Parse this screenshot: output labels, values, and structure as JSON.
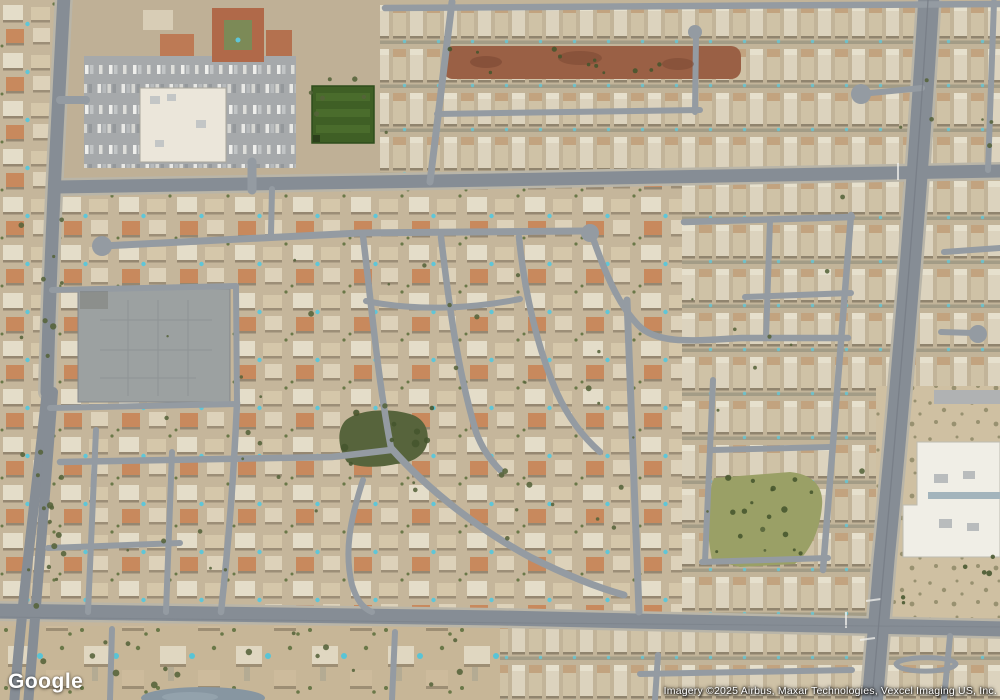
{
  "page": {
    "width": 1000,
    "height": 700,
    "view": "satellite"
  },
  "branding": {
    "logo_text": "Google"
  },
  "attribution": {
    "text": "Imagery ©2025 Airbus, Maxar Technologies, Vexcel Imaging US, Inc."
  },
  "palette": {
    "base": "#c6b69b",
    "street": "#949ba2",
    "arterial": "#868d95",
    "casing": "#b9b5a8",
    "dirt": "#9a6045",
    "field": "#3f5f25",
    "fieldStripe": "#4a6c2c",
    "park": "#57643c",
    "brush": "#9aa066",
    "pad": "#9ca1a1",
    "lot": "#a6a9ab",
    "store": "#ebe6da",
    "red": "#b06949",
    "redwing": "#b4714f",
    "white": "#f0eee6",
    "pond": "#8796a1",
    "pool": "#5ec6d8",
    "sand": "#cfc0a2",
    "tree": "#55633a",
    "treeDark": "#46552e",
    "unit": "#c3c6c6"
  },
  "map": {
    "regions": [
      {
        "name": "base-desert",
        "kind": "rect",
        "geom": [
          0,
          0,
          1000,
          700
        ],
        "fill": "$base"
      },
      {
        "name": "residential-bottom-left",
        "kind": "rect",
        "geom": [
          0,
          626,
          505,
          74
        ],
        "fill": "pat:lots"
      },
      {
        "name": "residential-bottom-right",
        "kind": "rect",
        "geom": [
          500,
          626,
          500,
          74
        ],
        "fill": "pat:rows"
      },
      {
        "name": "residential-top-right",
        "kind": "rect",
        "geom": [
          378,
          0,
          622,
          184
        ],
        "fill": "pat:rows"
      },
      {
        "name": "residential-top-left-corner",
        "kind": "rect",
        "geom": [
          0,
          0,
          60,
          188
        ],
        "fill": "pat:sub"
      },
      {
        "name": "commercial-apron",
        "kind": "rect",
        "geom": [
          58,
          0,
          322,
          188
        ],
        "fill": "#bfb096"
      },
      {
        "name": "residential-left-mid",
        "kind": "rect",
        "geom": [
          0,
          186,
          332,
          430
        ],
        "fill": "pat:sub"
      },
      {
        "name": "residential-center-fan",
        "kind": "rect",
        "geom": [
          332,
          186,
          352,
          430
        ],
        "fill": "pat:sub"
      },
      {
        "name": "residential-right-grid",
        "kind": "rect",
        "geom": [
          682,
          178,
          198,
          440
        ],
        "fill": "pat:rows"
      },
      {
        "name": "residential-east-top",
        "kind": "rect",
        "geom": [
          878,
          0,
          122,
          390
        ],
        "fill": "pat:rows"
      },
      {
        "name": "desert-east",
        "kind": "rect",
        "geom": [
          876,
          386,
          124,
          232
        ],
        "fill": "pat:shrub"
      },
      {
        "name": "dirt-strip",
        "kind": "rect",
        "geom": [
          443,
          46,
          298,
          33
        ],
        "rx": 10,
        "fill": "$dirt"
      },
      {
        "name": "retail-parking-lot",
        "kind": "rect",
        "geom": [
          84,
          56,
          212,
          112
        ],
        "fill": "pat:cars"
      },
      {
        "name": "retail-store",
        "kind": "rect",
        "geom": [
          140,
          88,
          86,
          74
        ],
        "fill": "$store",
        "stroke": "#a9a79c",
        "sw": 1
      },
      {
        "name": "apartment-complex",
        "kind": "rect",
        "geom": [
          212,
          8,
          52,
          54
        ],
        "fill": "$red"
      },
      {
        "name": "apartment-courtyard",
        "kind": "rect",
        "geom": [
          224,
          20,
          28,
          30
        ],
        "fill": "#7c8a57"
      },
      {
        "name": "apartment-wing",
        "kind": "rect",
        "geom": [
          266,
          30,
          26,
          26
        ],
        "fill": "$redwing"
      },
      {
        "name": "tan-building",
        "kind": "rect",
        "geom": [
          143,
          10,
          30,
          20
        ],
        "fill": "#d8cdb6"
      },
      {
        "name": "orange-roof-cluster",
        "kind": "rect",
        "geom": [
          160,
          34,
          34,
          22
        ],
        "fill": "#bd7a55"
      },
      {
        "name": "sports-field",
        "kind": "rect",
        "geom": [
          312,
          86,
          62,
          57
        ],
        "fill": "$field",
        "stroke": "#2f4d1c",
        "sw": 1.5
      },
      {
        "name": "concrete-pad",
        "kind": "rect",
        "geom": [
          78,
          289,
          152,
          113
        ],
        "fill": "$pad",
        "stroke": "#84888a",
        "sw": 1
      },
      {
        "name": "center-park",
        "kind": "path",
        "geom": "M347,462 C338,448 336,430 346,420 C360,409 390,408 410,414 C424,418 430,430 427,444 C424,456 412,463 396,464 C378,468 358,468 347,462 Z",
        "fill": "$park"
      },
      {
        "name": "brush-park",
        "kind": "path",
        "geom": "M712,560 C706,530 706,500 714,478 L790,472 C812,474 824,486 822,506 C820,530 810,552 795,564 L740,567 Z",
        "fill": "$brush"
      },
      {
        "name": "school-building",
        "kind": "path",
        "geom": "M917,442 L1000,442 L1000,557 L903,557 L903,505 L917,505 Z",
        "fill": "$white",
        "stroke": "#bdbbb0",
        "sw": 1
      },
      {
        "name": "school-drive",
        "kind": "rect",
        "geom": [
          934,
          390,
          66,
          14
        ],
        "fill": "#b0b2b3"
      },
      {
        "name": "pond",
        "kind": "ellipse",
        "geom": [
          203,
          698,
          62,
          11
        ],
        "fill": "$pond"
      }
    ],
    "roads": [
      {
        "name": "arterial-top",
        "d": "M56,187 L435,181 L1000,171",
        "w": 13,
        "c": "$arterial",
        "casing": true
      },
      {
        "name": "arterial-bottom",
        "d": "M-5,611 L500,618 L1005,629",
        "w": 15,
        "c": "$arterial",
        "casing": true
      },
      {
        "name": "arterial-left-upper",
        "d": "M64,-5 C57,130 50,260 47,392",
        "w": 13,
        "c": "$arterial",
        "casing": true
      },
      {
        "name": "arterial-left-west",
        "d": "M47,390 C36,492 22,600 14,705",
        "w": 10,
        "c": "$arterial"
      },
      {
        "name": "arterial-left-east",
        "d": "M53,392 C45,497 35,617 28,705",
        "w": 10,
        "c": "$arterial"
      },
      {
        "name": "arterial-right",
        "d": "M929,-5 C917,200 898,420 884,560 L872,705",
        "w": 21,
        "c": "$arterial",
        "casing": true
      },
      {
        "name": "street-top-vertical",
        "d": "M452,2 L430,182",
        "w": 7
      },
      {
        "name": "street-top-edge",
        "d": "M385,8 L1000,4",
        "w": 6.5
      },
      {
        "name": "street-upper-mid",
        "d": "M437,114 L700,110",
        "w": 6
      },
      {
        "name": "street-upper-stub",
        "d": "M695,112 L696,36",
        "w": 6
      },
      {
        "name": "street-loop-ne",
        "d": "M861,94 L922,88",
        "w": 6
      },
      {
        "name": "collector-mid",
        "d": "M102,246 L360,233 L583,231",
        "w": 7
      },
      {
        "name": "fan-arc-1",
        "d": "M363,236 C372,310 378,380 391,448",
        "w": 6.5
      },
      {
        "name": "fan-arc-2",
        "d": "M441,237 C449,305 458,372 476,432 C481,446 490,460 501,471",
        "w": 6.5
      },
      {
        "name": "fan-arc-3",
        "d": "M519,237 C524,288 536,345 557,393 C567,415 582,436 600,452",
        "w": 6.5
      },
      {
        "name": "fan-arc-4",
        "d": "M594,241 C610,286 622,308 638,325 C658,346 700,340 742,338 L848,338",
        "w": 6.5
      },
      {
        "name": "fan-connector",
        "d": "M366,301 C420,312 475,308 520,299",
        "w": 6
      },
      {
        "name": "fan-lower-diagonal",
        "d": "M391,448 C430,492 480,530 530,557 C560,572 592,586 624,595",
        "w": 7
      },
      {
        "name": "street-left-join",
        "d": "M60,462 L332,457 L391,450",
        "w": 6.5
      },
      {
        "name": "street-s-curve",
        "d": "M363,480 C350,520 344,552 352,585 C357,601 363,608 372,612",
        "w": 6
      },
      {
        "name": "street-mid-vertical",
        "d": "M627,300 L639,612",
        "w": 7
      },
      {
        "name": "grid-top",
        "d": "M684,222 L852,217",
        "w": 6.5
      },
      {
        "name": "grid-2",
        "d": "M745,297 L851,293",
        "w": 6
      },
      {
        "name": "grid-3",
        "d": "M712,450 L830,447",
        "w": 6
      },
      {
        "name": "grid-4",
        "d": "M702,562 L828,558",
        "w": 6
      },
      {
        "name": "grid-east-vertical",
        "d": "M851,215 L823,570",
        "w": 6.5
      },
      {
        "name": "grid-west-vertical",
        "d": "M713,380 L705,562",
        "w": 6
      },
      {
        "name": "grid-inner-vertical",
        "d": "M770,221 L766,338",
        "w": 6
      },
      {
        "name": "stub-east-1",
        "d": "M944,252 L1000,248",
        "w": 6
      },
      {
        "name": "stub-east-2",
        "d": "M941,332 L973,333",
        "w": 6
      },
      {
        "name": "street-east-edge",
        "d": "M994,2 L988,170",
        "w": 6
      },
      {
        "name": "pad-top-street",
        "d": "M52,290 L236,286",
        "w": 6
      },
      {
        "name": "pad-right-street",
        "d": "M236,286 L237,403",
        "w": 6
      },
      {
        "name": "pad-bottom-street",
        "d": "M50,408 L237,404",
        "w": 6
      },
      {
        "name": "street-left-south",
        "d": "M237,403 C234,470 229,540 221,612",
        "w": 6.5
      },
      {
        "name": "street-left-v1",
        "d": "M96,430 L88,612",
        "w": 6
      },
      {
        "name": "street-left-v2",
        "d": "M172,452 L166,612",
        "w": 6
      },
      {
        "name": "street-left-h2",
        "d": "M48,548 L180,543",
        "w": 6
      },
      {
        "name": "connector-top-left",
        "d": "M272,189 L271,234",
        "w": 6
      },
      {
        "name": "bottom-stub-1",
        "d": "M112,629 L110,700",
        "w": 6
      },
      {
        "name": "bottom-stub-2",
        "d": "M395,632 L392,700",
        "w": 6
      },
      {
        "name": "bottom-v",
        "d": "M658,655 L655,700",
        "w": 6
      },
      {
        "name": "bottom-h",
        "d": "M640,674 L852,670",
        "w": 6
      },
      {
        "name": "bottom-v2",
        "d": "M950,636 L944,700",
        "w": 6
      },
      {
        "name": "se-loop",
        "d": "M896,664 C900,656 952,655 956,664 C952,673 900,674 896,664 Z",
        "w": 5
      },
      {
        "name": "lot-drive",
        "d": "M252,162 L252,190",
        "w": 9
      },
      {
        "name": "lot-entry",
        "d": "M60,100 L86,100",
        "w": 8
      }
    ],
    "bulbs": [
      [
        102,
        246,
        10
      ],
      [
        590,
        233,
        9
      ],
      [
        695,
        32,
        7
      ],
      [
        861,
        94,
        10
      ],
      [
        978,
        334,
        9
      ]
    ],
    "details": [
      {
        "name": "field-stripe-1",
        "kind": "rect",
        "geom": [
          316,
          93,
          54,
          8
        ],
        "fill": "$fieldStripe"
      },
      {
        "name": "field-stripe-2",
        "kind": "rect",
        "geom": [
          316,
          109,
          54,
          8
        ],
        "fill": "$fieldStripe"
      },
      {
        "name": "field-stripe-3",
        "kind": "rect",
        "geom": [
          316,
          125,
          54,
          8
        ],
        "fill": "$fieldStripe"
      },
      {
        "name": "field-corner",
        "kind": "rect",
        "geom": [
          313,
          135,
          7,
          7
        ],
        "fill": "#2c401b"
      },
      {
        "name": "pad-markings",
        "kind": "line",
        "geom": "M100,320 H212 M100,350 H212 M100,378 H196 M128,300 V396 M158,300 V396 M188,300 V396",
        "stroke": "#8d9293",
        "sw": 1,
        "opacity": 0.9
      },
      {
        "name": "pad-stain",
        "kind": "rect",
        "geom": [
          80,
          291,
          28,
          18
        ],
        "fill": "rgba(85,80,70,0.22)"
      },
      {
        "name": "store-unit-1",
        "kind": "rect",
        "geom": [
          150,
          96,
          10,
          8
        ],
        "fill": "$unit"
      },
      {
        "name": "store-unit-2",
        "kind": "rect",
        "geom": [
          167,
          94,
          9,
          7
        ],
        "fill": "$unit"
      },
      {
        "name": "store-unit-3",
        "kind": "rect",
        "geom": [
          196,
          120,
          10,
          8
        ],
        "fill": "$unit"
      },
      {
        "name": "store-unit-4",
        "kind": "rect",
        "geom": [
          155,
          140,
          9,
          7
        ],
        "fill": "$unit"
      },
      {
        "name": "school-strip",
        "kind": "rect",
        "geom": [
          928,
          492,
          72,
          7
        ],
        "fill": "#a3b4bc"
      },
      {
        "name": "school-unit-1",
        "kind": "rect",
        "geom": [
          934,
          474,
          14,
          9
        ],
        "fill": "#b9bcbd"
      },
      {
        "name": "school-unit-2",
        "kind": "rect",
        "geom": [
          963,
          471,
          12,
          8
        ],
        "fill": "#b9bcbd"
      },
      {
        "name": "school-unit-3",
        "kind": "rect",
        "geom": [
          939,
          519,
          13,
          9
        ],
        "fill": "#b9bcbd"
      },
      {
        "name": "school-unit-4",
        "kind": "rect",
        "geom": [
          967,
          523,
          12,
          8
        ],
        "fill": "#b9bcbd"
      },
      {
        "name": "complex-pool",
        "kind": "circle",
        "geom": [
          238,
          40,
          2.5
        ],
        "fill": "$pool"
      },
      {
        "name": "pond-highlight",
        "kind": "ellipse",
        "geom": [
          190,
          697,
          28,
          5
        ],
        "fill": "#93a2ac"
      },
      {
        "name": "dirt-blotch-1",
        "kind": "ellipse",
        "geom": [
          486,
          62,
          16,
          6
        ],
        "fill": "rgba(120,70,50,0.55)"
      },
      {
        "name": "dirt-blotch-2",
        "kind": "ellipse",
        "geom": [
          580,
          58,
          22,
          7
        ],
        "fill": "rgba(120,70,50,0.5)"
      },
      {
        "name": "dirt-blotch-3",
        "kind": "ellipse",
        "geom": [
          678,
          64,
          16,
          6
        ],
        "fill": "rgba(120,70,50,0.5)"
      },
      {
        "name": "crosswalk-marks",
        "kind": "line",
        "geom": "M846,612 l0,16 M866,601 l15,-2 M860,640 l15,-2 M898,163 l0,17",
        "stroke": "#f2f2ee",
        "sw": 2,
        "opacity": 0.75
      },
      {
        "name": "median-seam",
        "kind": "line",
        "geom": "M928,0 C916,200 897,420 872,700",
        "stroke": "#757c84",
        "sw": 1.3,
        "opacity": 0.8
      },
      {
        "name": "a2-seam",
        "kind": "line",
        "geom": "M0,617 C300,622 700,624 1000,627",
        "stroke": "#7a8188",
        "sw": 1,
        "opacity": 0.6
      }
    ],
    "tree_clusters": [
      {
        "box": [
          20,
          195,
          42,
          420
        ],
        "n": 16,
        "color": "tree",
        "rmin": 1.5,
        "rmax": 3.5
      },
      {
        "box": [
          295,
          70,
          95,
          80
        ],
        "n": 7,
        "color": "tree",
        "rmin": 1.5,
        "rmax": 3
      },
      {
        "box": [
          338,
          406,
          95,
          62
        ],
        "n": 9,
        "color": "treeDark",
        "rmin": 2,
        "rmax": 4
      },
      {
        "box": [
          350,
          240,
          300,
          330
        ],
        "n": 24,
        "color": "tree",
        "rmin": 1.2,
        "rmax": 3
      },
      {
        "box": [
          90,
          240,
          235,
          340
        ],
        "n": 16,
        "color": "tree",
        "rmin": 1.2,
        "rmax": 3
      },
      {
        "box": [
          690,
          195,
          180,
          370
        ],
        "n": 12,
        "color": "tree",
        "rmin": 1.2,
        "rmax": 2.8
      },
      {
        "box": [
          0,
          630,
          500,
          62
        ],
        "n": 16,
        "color": "tree",
        "rmin": 1.5,
        "rmax": 3.5
      },
      {
        "box": [
          885,
          556,
          110,
          52
        ],
        "n": 6,
        "color": "treeDark",
        "rmin": 1.5,
        "rmax": 3
      },
      {
        "box": [
          706,
          470,
          118,
          96
        ],
        "n": 16,
        "color": "treeDark",
        "rmin": 1.5,
        "rmax": 3.2
      },
      {
        "box": [
          444,
          49,
          294,
          26
        ],
        "n": 12,
        "color": "treeDark",
        "rmin": 1.2,
        "rmax": 2.6
      },
      {
        "box": [
          898,
          2,
          100,
          168
        ],
        "n": 6,
        "color": "tree",
        "rmin": 1.2,
        "rmax": 2.5
      },
      {
        "box": [
          36,
          420,
          34,
          195
        ],
        "n": 8,
        "color": "tree",
        "rmin": 1.5,
        "rmax": 3
      }
    ]
  }
}
